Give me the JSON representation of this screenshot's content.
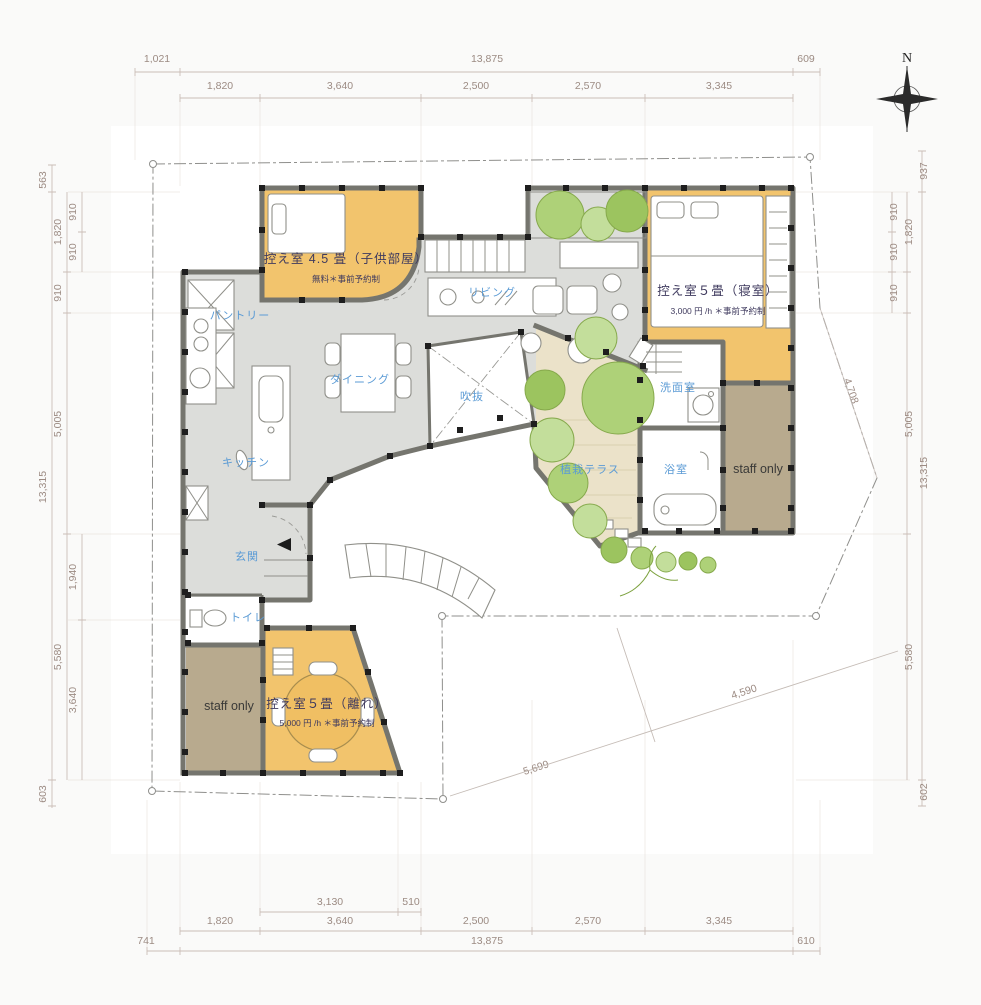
{
  "compass": {
    "north": "N"
  },
  "rooms": [
    {
      "id": "child",
      "name": "控え室 4.5 畳（子供部屋）",
      "note": "無料＊事前予約制"
    },
    {
      "id": "bedroom",
      "name": "控え室５畳（寝室）",
      "note": "3,000 円 /h ＊事前予約制"
    },
    {
      "id": "hanare",
      "name": "控え室５畳（離れ）",
      "note": "5,000 円 /h ＊事前予約制"
    }
  ],
  "labels": {
    "living": "リビング",
    "dining": "ダイニング",
    "kitchen": "キッチン",
    "pantry": "パントリー",
    "void": "吹抜",
    "entrance": "玄関",
    "toilet": "トイレ",
    "washroom": "洗面室",
    "bath": "浴室",
    "terrace": "植栽テラス",
    "staff_right": "staff only",
    "staff_left": "staff only"
  },
  "dimensions": {
    "top_outer": [
      "1,021",
      "13,875",
      "609"
    ],
    "top_inner": [
      "1,820",
      "3,640",
      "2,500",
      "2,570",
      "3,345"
    ],
    "bottom_sub": [
      "3,130",
      "510"
    ],
    "bottom_inner": [
      "1,820",
      "3,640",
      "2,500",
      "2,570",
      "3,345"
    ],
    "bottom_outer": [
      "741",
      "13,875",
      "610"
    ],
    "left_outer": [
      "563",
      "13,315",
      "603"
    ],
    "left_mid": [
      "1,820",
      "910",
      "5,005",
      "5,580"
    ],
    "left_inner": [
      "910",
      "910",
      "1,940",
      "3,640"
    ],
    "right_outer": [
      "937",
      "13,315",
      "602"
    ],
    "right_mid": [
      "1,820",
      "5,005",
      "5,580"
    ],
    "right_inner": [
      "910",
      "910",
      "910"
    ],
    "diag_right": "4,708",
    "diag_bottom": [
      "5,699",
      "4,590"
    ]
  },
  "colors": {
    "room_orange": "#f2c46d",
    "staff_tan": "#b8aa8e",
    "floor_gray": "#dcddda",
    "terrace_beige": "#ebe2c9",
    "tree_green_dark": "#9cc45f",
    "tree_green_mid": "#aed178",
    "tree_green_light": "#c3de9b",
    "label_blue": "#5b9bd5",
    "room_text": "#3f3a5e",
    "dimension_text": "#9c8b83"
  }
}
